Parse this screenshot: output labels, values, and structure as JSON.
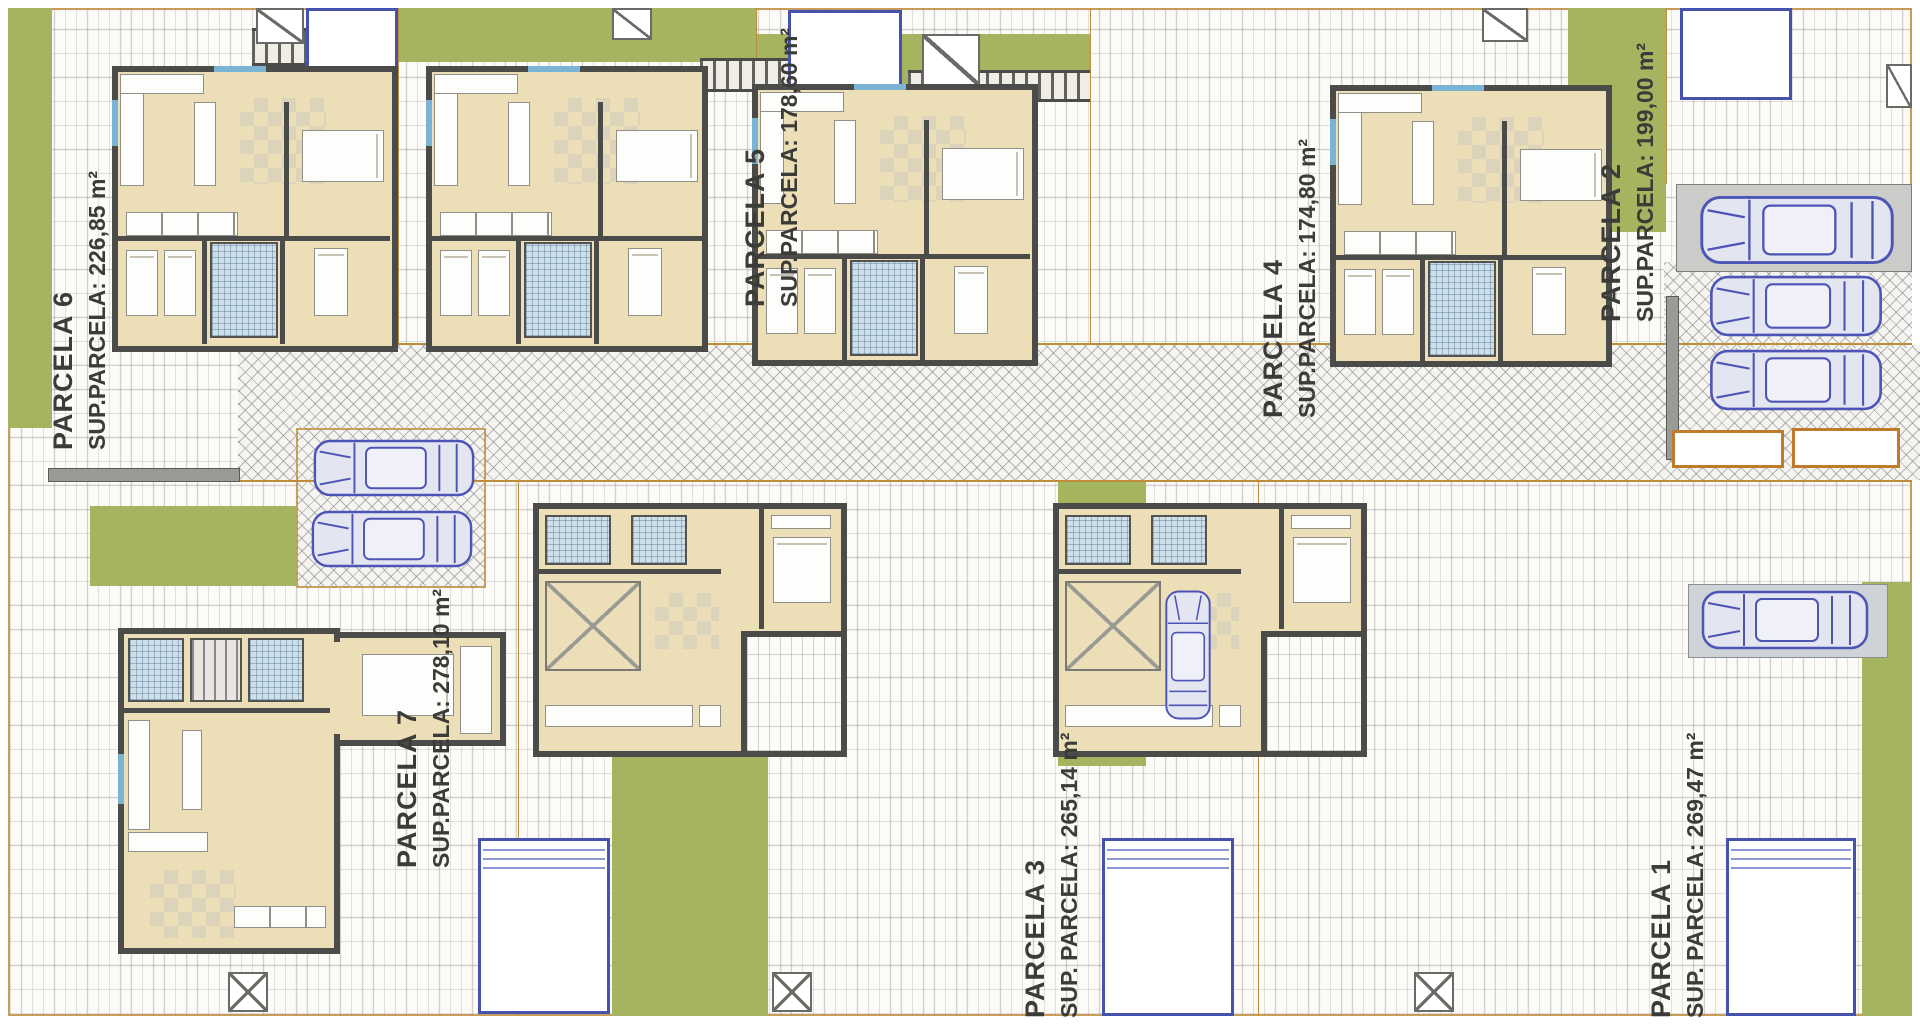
{
  "drawing_type": "residential urbanization site plan with house floor plans",
  "parcels": [
    {
      "name": "PARCELA 6",
      "area": "SUP.PARCELA: 226,85 m²"
    },
    {
      "name": "PARCELA 5",
      "area": "SUP.PARCELA: 178,60 m²"
    },
    {
      "name": "PARCELA 4",
      "area": "SUP.PARCELA: 174,80 m²"
    },
    {
      "name": "PARCELA 2",
      "area": "SUP.PARCELA: 199,00 m²"
    },
    {
      "name": "PARCELA 7",
      "area": "SUP.PARCELA: 278,10 m²"
    },
    {
      "name": "PARCELA 3",
      "area": "SUP. PARCELA: 265,14 m²"
    },
    {
      "name": "PARCELA 1",
      "area": "SUP. PARCELA: 269,47 m²"
    }
  ],
  "counts": {
    "houses": 7,
    "cars": 7,
    "pools": 6
  },
  "colors": {
    "garden_green": "#a4b45f",
    "house_floor_beige": "#ecdfb8",
    "wall_dark": "#4b4b49",
    "pool_border_blue": "#4653ae",
    "car_outline_blue": "#4c54b6",
    "boundary_orange": "#bf8c3e",
    "bath_tile_blue": "#cfdfe9",
    "paving_white": "#fcfbf7"
  },
  "icons": {
    "car-icon": "top-view car outline drawing",
    "pool-icon": "white rectangle with blue border",
    "utility-marker-icon": "white square with diagonal stroke",
    "pergola-icon": "striped slat band"
  }
}
